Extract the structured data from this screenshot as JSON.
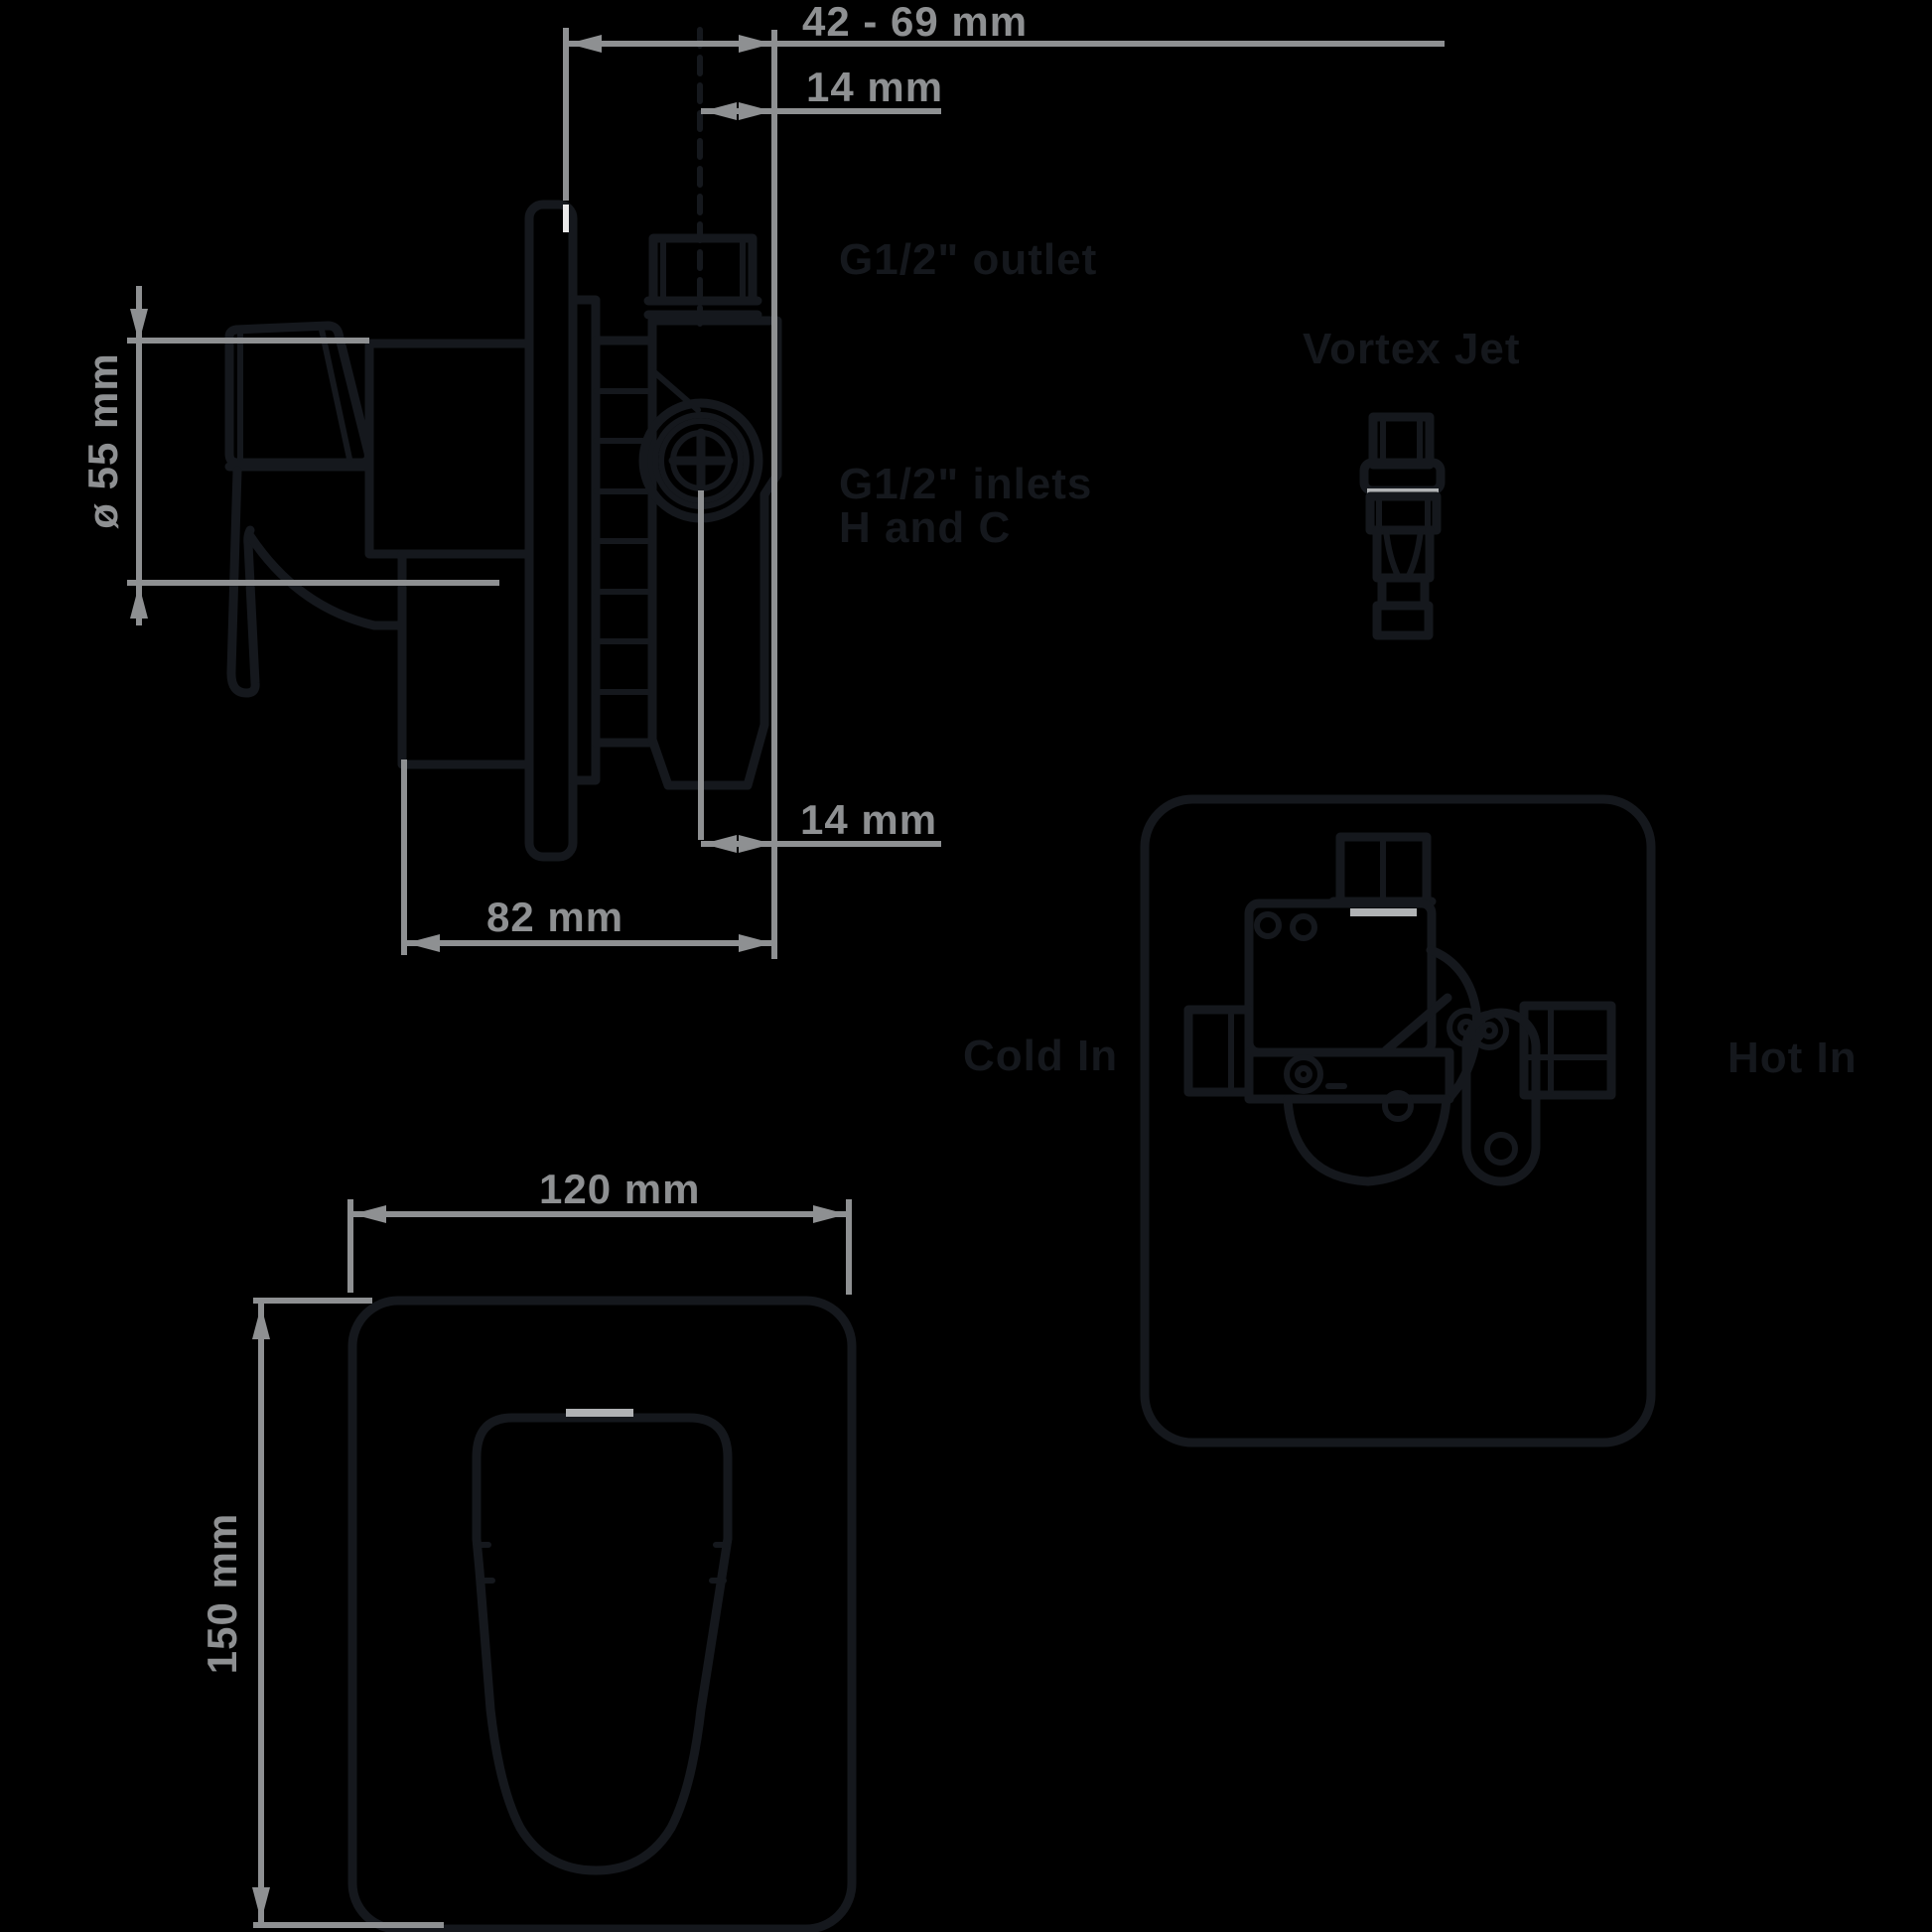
{
  "diagram": {
    "type": "technical-dimension-drawing",
    "subject": "concealed shower mixer valve",
    "colors": {
      "background": "#000000",
      "drawing_line": "#15181d",
      "dimension_gray": "#8e9092",
      "accent_light_gray": "#b0b2b4",
      "white_tick": "#e9e9e9"
    },
    "side_view": {
      "dim_span": "42 - 69 mm",
      "dim_offset_top": "14 mm",
      "outlet_label": "G1/2\" outlet",
      "inlets_label_line1": "G1/2\" inlets",
      "inlets_label_line2": "H and C",
      "dim_diameter": "ø 55 mm",
      "dim_offset_bottom": "14 mm",
      "dim_depth": "82 mm"
    },
    "vortex_jet": {
      "label": "Vortex Jet"
    },
    "rear_view": {
      "cold_label": "Cold In",
      "hot_label": "Hot In"
    },
    "front_view": {
      "dim_width": "120 mm",
      "dim_height": "150 mm"
    }
  }
}
